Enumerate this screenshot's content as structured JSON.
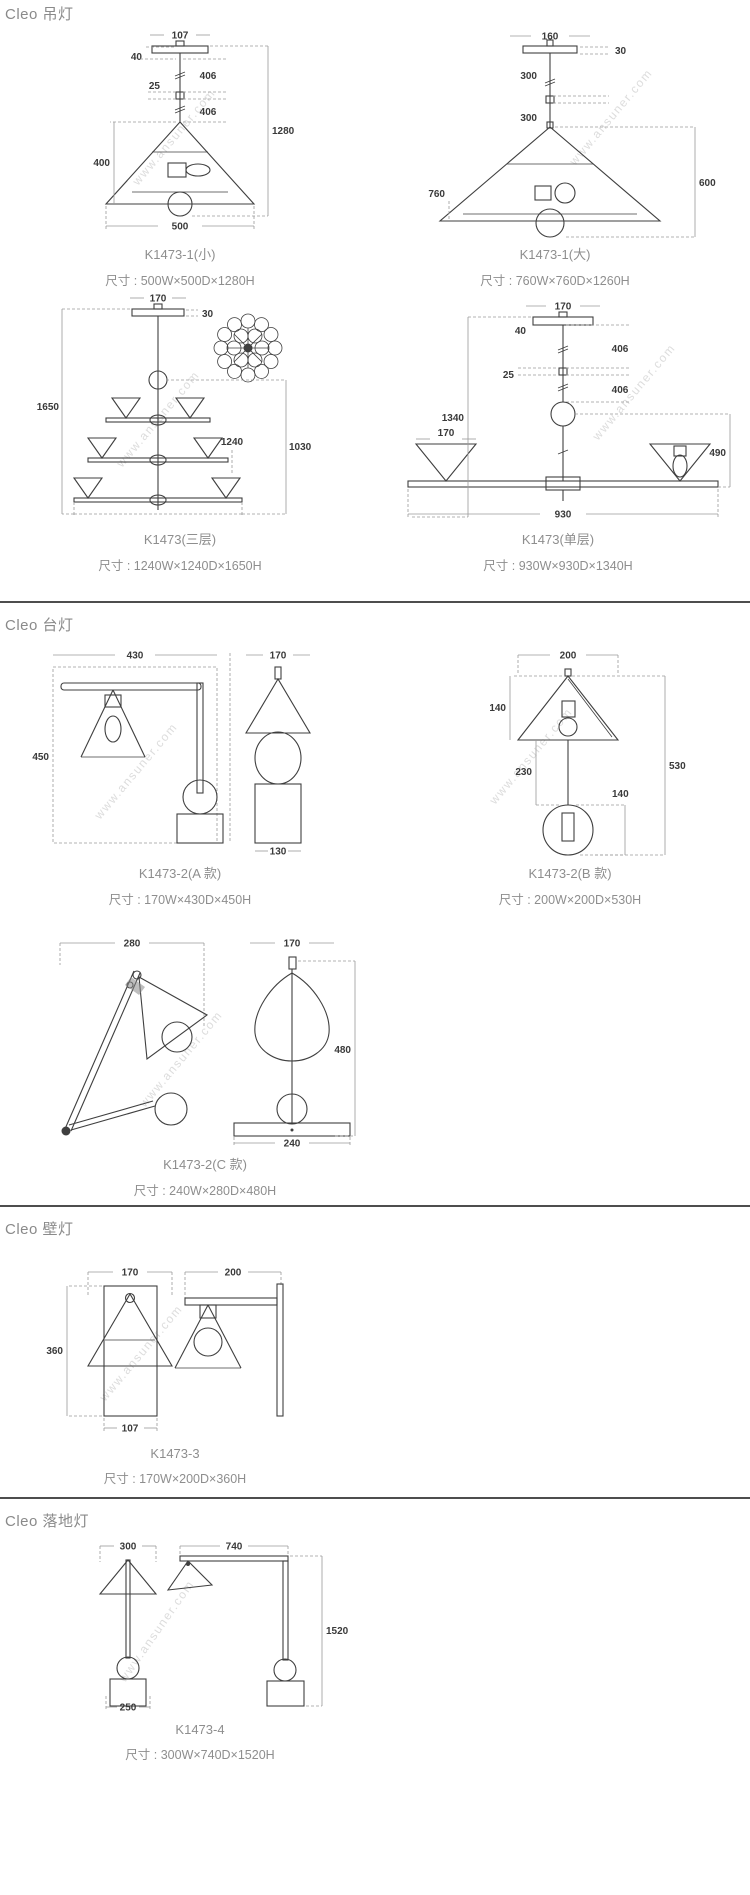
{
  "watermark": "www.ansuner.com",
  "sections": {
    "pendant": {
      "title": "Cleo 吊灯"
    },
    "table": {
      "title": "Cleo 台灯"
    },
    "wall": {
      "title": "Cleo 壁灯"
    },
    "floor": {
      "title": "Cleo 落地灯"
    }
  },
  "figures": {
    "pendant_small": {
      "caption": "K1473-1(小)",
      "size": "尺寸 : 500W×500D×1280H",
      "dims": {
        "top_w": "107",
        "canopy_h": "40",
        "seg1": "406",
        "mid": "25",
        "seg2": "406",
        "total_h": "1280",
        "shade_h": "400",
        "shade_w": "500"
      }
    },
    "pendant_large": {
      "caption": "K1473-1(大)",
      "size": "尺寸 : 760W×760D×1260H",
      "dims": {
        "top_w": "160",
        "canopy_h": "30",
        "seg1": "300",
        "seg2": "300",
        "shade_w": "760",
        "shade_h": "600"
      }
    },
    "pendant_three": {
      "caption": "K1473(三层)",
      "size": "尺寸 : 1240W×1240D×1650H",
      "dims": {
        "top_w": "170",
        "canopy_h": "30",
        "total_h": "1650",
        "width": "1240",
        "inner_h": "1030"
      }
    },
    "pendant_single": {
      "caption": "K1473(单层)",
      "size": "尺寸 : 930W×930D×1340H",
      "dims": {
        "top_w": "170",
        "canopy_h": "40",
        "seg1": "406",
        "mid": "25",
        "seg2": "406",
        "total_h": "1340",
        "shade_w": "170",
        "lower_h": "490",
        "width": "930"
      }
    },
    "table_a": {
      "caption": "K1473-2(A 款)",
      "size": "尺寸 : 170W×430D×450H",
      "dims": {
        "depth": "430",
        "shade_w": "170",
        "total_h": "450",
        "base_w": "130"
      }
    },
    "table_b": {
      "caption": "K1473-2(B 款)",
      "size": "尺寸 : 200W×200D×530H",
      "dims": {
        "shade_w": "200",
        "shade_h": "140",
        "rod_h": "230",
        "ball_d": "140",
        "total_h": "530"
      }
    },
    "table_c": {
      "caption": "K1473-2(C 款)",
      "size": "尺寸 : 240W×280D×480H",
      "dims": {
        "depth": "280",
        "shade_w": "170",
        "total_h": "480",
        "base_w": "240"
      }
    },
    "wall_lamp": {
      "caption": "K1473-3",
      "size": "尺寸 : 170W×200D×360H",
      "dims": {
        "shade_w": "170",
        "depth": "200",
        "total_h": "360",
        "base_w": "107"
      }
    },
    "floor_lamp": {
      "caption": "K1473-4",
      "size": "尺寸 : 300W×740D×1520H",
      "dims": {
        "shade_w": "300",
        "depth": "740",
        "total_h": "1520",
        "base_w": "250"
      }
    }
  }
}
